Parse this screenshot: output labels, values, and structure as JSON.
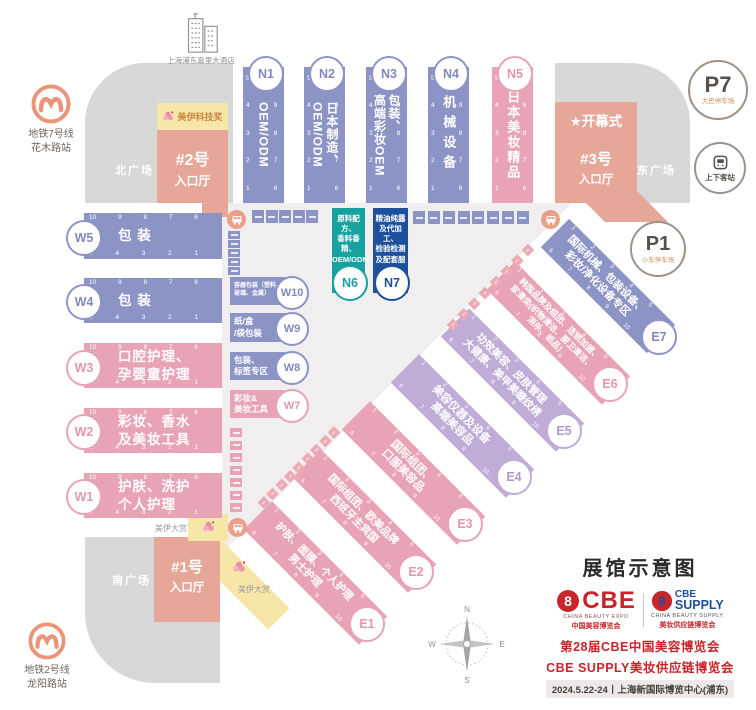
{
  "title": "展馆示意图",
  "colors": {
    "hall_purple": "#8C94C6",
    "hall_pink": "#E8A3B7",
    "hall_lavender": "#BFACD7",
    "hall_teal": "#17A2A0",
    "hall_navy": "#1C4F9C",
    "entrance_salmon": "#E6A698",
    "plaza_grey": "#D8D8D8",
    "corridor_grey": "#F0EEEF",
    "highlight_yellow": "#F6E7A9",
    "metro_orange": "#E89579",
    "brand_red": "#C8242B",
    "brand_blue": "#1F4E9C"
  },
  "stations": {
    "metro7": [
      "地铁7号线",
      "花木路站"
    ],
    "metro2": [
      "地铁2号线",
      "龙阳路站"
    ],
    "hotel": "上海浦东嘉里大酒店",
    "dropoff": "上下客站"
  },
  "plazas": {
    "north": "北广场",
    "south": "南广场",
    "east": "东广场"
  },
  "entrances": {
    "no1": [
      "#1号",
      "入口厅"
    ],
    "no2": [
      "#2号",
      "入口厅"
    ],
    "no3": [
      "#3号",
      "入口厅"
    ],
    "opening_star": "★",
    "opening": "开幕式"
  },
  "awards": {
    "tech": "美伊科技奖",
    "grand": "美伊大赏"
  },
  "parking": {
    "p7": {
      "id": "P7",
      "label": "大巴停车场"
    },
    "p1": {
      "id": "P1",
      "label": "小车停车场"
    }
  },
  "halls": {
    "n1": {
      "id": "N1",
      "lines": [
        "OEM/ODM"
      ]
    },
    "n2": {
      "id": "N2",
      "lines": [
        "日本制造、",
        "OEM/ODM"
      ]
    },
    "n3": {
      "id": "N3",
      "lines": [
        "包装、",
        "高端彩妆OEM"
      ]
    },
    "n4": {
      "id": "N4",
      "lines": [
        "机械设备"
      ]
    },
    "n5": {
      "id": "N5",
      "lines": [
        "日本美妆精品"
      ]
    },
    "n6": {
      "id": "N6",
      "lines": [
        "原料配方、",
        "香料香精、",
        "OEM/ODM"
      ]
    },
    "n7": {
      "id": "N7",
      "lines": [
        "精油纯露",
        "及代加工、",
        "检验检测",
        "及配套服务"
      ]
    },
    "w1": {
      "id": "W1",
      "lines": [
        "护肤、洗护",
        "个人护理"
      ]
    },
    "w2": {
      "id": "W2",
      "lines": [
        "彩妆、香水",
        "及美妆工具"
      ]
    },
    "w3": {
      "id": "W3",
      "lines": [
        "口腔护理、",
        "孕婴童护理"
      ]
    },
    "w4": {
      "id": "W4",
      "lines": [
        "包 装"
      ]
    },
    "w5": {
      "id": "W5",
      "lines": [
        "包 装"
      ]
    },
    "w7": {
      "id": "W7",
      "lines": [
        "彩妆&",
        "美妆工具"
      ]
    },
    "w8": {
      "id": "W8",
      "lines": [
        "包装、",
        "标签专区"
      ]
    },
    "w9": {
      "id": "W9",
      "lines": [
        "纸/盒",
        "/袋包装"
      ]
    },
    "w10": {
      "id": "W10",
      "lines": [
        "容器包装（塑料、",
        "玻璃、金属）"
      ]
    },
    "e1": {
      "id": "E1",
      "lines": [
        "护肤、面膜、个人护理",
        "男士护理"
      ]
    },
    "e2": {
      "id": "E2",
      "lines": [
        "国际组团、欧美品牌",
        "西班牙主宾国"
      ]
    },
    "e3": {
      "id": "E3",
      "lines": [
        "国际组团、",
        "口服美容品"
      ]
    },
    "e4": {
      "id": "E4",
      "lines": [
        "美容仪器及设备",
        "高端美容品"
      ]
    },
    "e5": {
      "id": "E5",
      "lines": [
        "功效美容、皮肤管理",
        "大健康、美甲美睫纹绣"
      ]
    },
    "e6": {
      "id": "E6",
      "lines": [
        "韩国品牌及组团、连锁加盟、",
        "家清类(织物清洁、厨卫清洁、",
        "消杀、纸品)"
      ]
    },
    "e7": {
      "id": "E7",
      "lines": [
        "国际机械、包装设备、",
        "彩妆/净化设备专区"
      ]
    }
  },
  "ticks": {
    "desc": [
      "10",
      "9",
      "8",
      "7",
      "6"
    ],
    "asc": [
      "5",
      "4",
      "3",
      "2",
      "1"
    ],
    "e_top": [
      "1",
      "2",
      "3",
      "4",
      "5"
    ],
    "e_bottom": [
      "6",
      "7",
      "8",
      "9",
      "10"
    ]
  },
  "compass": {
    "n": "N",
    "e": "E",
    "s": "S",
    "w": "W"
  },
  "footer": {
    "title": "展馆示意图",
    "cbe_name": "CBE",
    "cbe_sub_en": "CHINA BEAUTY EXPO",
    "cbe_sub_cn": "中国美容博览会",
    "supply_name1": "CBE",
    "supply_name2": "SUPPLY",
    "supply_sub_en": "CHINA BEAUTY SUPPLY",
    "supply_sub_cn": "美妆供应链博览会",
    "event_line1": "第28届CBE中国美容博览会",
    "event_line2": "CBE SUPPLY美妆供应链博览会",
    "event_line3": "2024.5.22-24丨上海新国际博览中心(浦东)"
  },
  "decor": {
    "row_left": 5,
    "col_left": 5,
    "row_right": 8,
    "col_w7": 7,
    "diag_a": 8,
    "diag_b": 9
  }
}
